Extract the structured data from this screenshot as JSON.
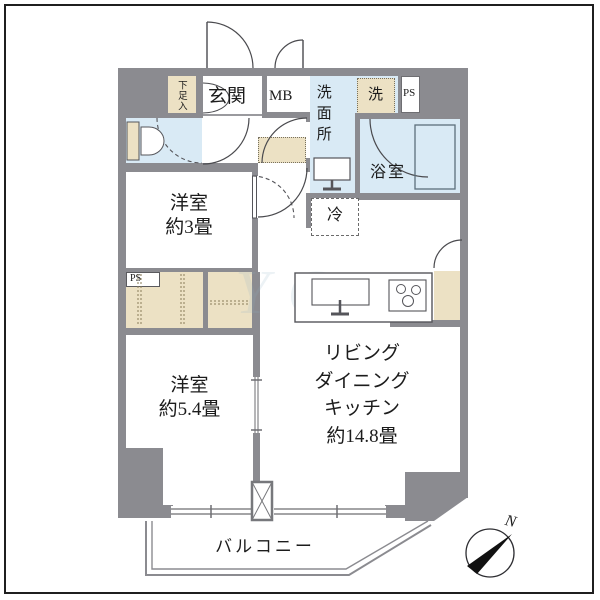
{
  "rooms": {
    "entrance": "玄関",
    "meter_box": "MB",
    "shoe_cabinet": "下足入",
    "washroom": "洗面所",
    "washer": "洗",
    "pipe_space_top": "PS",
    "pipe_space_left": "PS",
    "bathroom": "浴室",
    "refrigerator": "冷",
    "western_room_3": {
      "name": "洋室",
      "size": "約3畳"
    },
    "ldk": {
      "line1": "リビング",
      "line2": "ダイニング",
      "line3": "キッチン",
      "size": "約14.8畳"
    },
    "western_room_54": {
      "name": "洋室",
      "size": "約5.4畳"
    },
    "balcony": "バルコニー"
  },
  "compass": {
    "north_label": "N"
  },
  "watermark": "YC",
  "colors": {
    "wall": "#8b8b90",
    "wet_area": "#d9eaf5",
    "storage": "#ece1c4",
    "line": "#4a4a4e",
    "frame": "#1f1f1f"
  }
}
